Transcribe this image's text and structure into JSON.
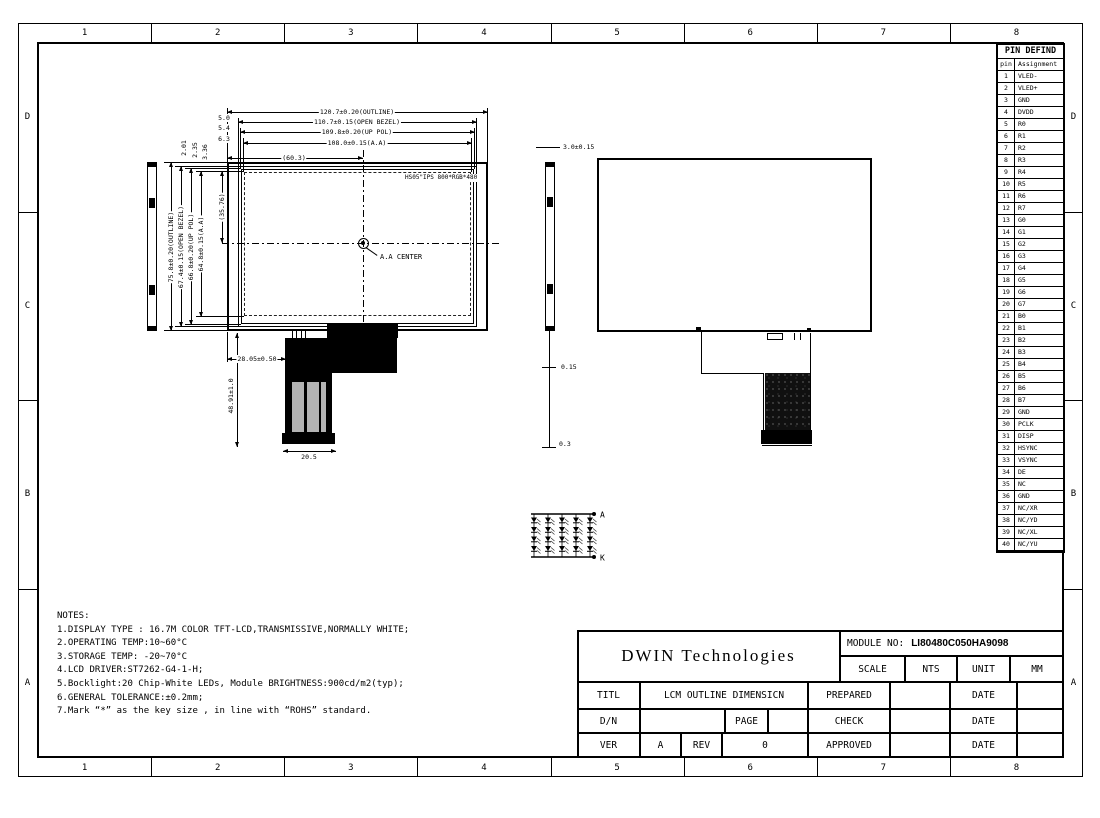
{
  "sheet": {
    "cols": [
      "1",
      "2",
      "3",
      "4",
      "5",
      "6",
      "7",
      "8"
    ],
    "rows": [
      "D",
      "C",
      "B",
      "A"
    ]
  },
  "front_view": {
    "top_dims": [
      "120.7±0.20(OUTLINE)",
      "110.7±0.15(OPEN BEZEL)",
      "109.8±0.20(UP POL)",
      "108.0±0.15(A.A)"
    ],
    "half_width_dim": "(60.3)",
    "left_dims": [
      "75.8±0.20(OUTLINE)",
      "67.4±0.15(OPEN BEZEL)",
      "66.8±0.20(UP POL)",
      "64.8±0.15(A.A)"
    ],
    "half_height_dim": "(35.76)",
    "left_offsets": [
      "5.0",
      "5.4",
      "6.3"
    ],
    "top_offsets": [
      "2.01",
      "2.35",
      "3.36"
    ],
    "panel_label": "HS05\"IPS 800*RGB*480",
    "center_label": "A.A CENTER",
    "fpc_offset_dim": "28.05±0.50",
    "fpc_length_dim": "48.91±1.0",
    "fpc_width_dim": "20.5"
  },
  "side_view": {
    "thickness_dim": "3.0±0.15",
    "tape_dim": "0.15",
    "protrusion_dim": "0.3"
  },
  "led_circuit": {
    "anode_label": "A",
    "cathode_label": "K",
    "rows": 4,
    "cols": 5
  },
  "notes": {
    "title": "NOTES:",
    "lines": [
      "1.DISPLAY TYPE : 16.7M COLOR TFT-LCD,TRANSMISSIVE,NORMALLY WHITE;",
      "2.OPERATING TEMP:10~60°C",
      "3.STORAGE TEMP: -20~70°C",
      "4.LCD DRIVER:ST7262-G4-1-H;",
      "5.Bocklight:20 Chip-White LEDs, Module BRIGHTNESS:900cd/m2(typ);",
      "6.GENERAL TOLERANCE:±0.2mm;",
      "7.Mark “*” as the key size , in line with “ROHS” standard."
    ]
  },
  "title_block": {
    "company": "DWIN Technologies",
    "module_no_label": "MODULE NO:",
    "module_no_value": "LI80480C050HA9098",
    "scale_label": "SCALE",
    "scale_value": "NTS",
    "unit_label": "UNIT",
    "unit_value": "MM",
    "title_label": "TITL",
    "title_value": "LCM OUTLINE DIMENSICN",
    "prepared_label": "PREPARED",
    "check_label": "CHECK",
    "approved_label": "APPROVED",
    "date_label": "DATE",
    "dn_label": "D/N",
    "page_label": "PAGE",
    "ver_label": "VER",
    "ver_value": "A",
    "rev_label": "REV",
    "rev_value": "0"
  },
  "pin_table": {
    "title": "PIN DEFIND",
    "headers": [
      "pin",
      "Assignment"
    ],
    "pins": [
      [
        "1",
        "VLED-"
      ],
      [
        "2",
        "VLED+"
      ],
      [
        "3",
        "GND"
      ],
      [
        "4",
        "DVDD"
      ],
      [
        "5",
        "R0"
      ],
      [
        "6",
        "R1"
      ],
      [
        "7",
        "R2"
      ],
      [
        "8",
        "R3"
      ],
      [
        "9",
        "R4"
      ],
      [
        "10",
        "R5"
      ],
      [
        "11",
        "R6"
      ],
      [
        "12",
        "R7"
      ],
      [
        "13",
        "G0"
      ],
      [
        "14",
        "G1"
      ],
      [
        "15",
        "G2"
      ],
      [
        "16",
        "G3"
      ],
      [
        "17",
        "G4"
      ],
      [
        "18",
        "G5"
      ],
      [
        "19",
        "G6"
      ],
      [
        "20",
        "G7"
      ],
      [
        "21",
        "B0"
      ],
      [
        "22",
        "B1"
      ],
      [
        "23",
        "B2"
      ],
      [
        "24",
        "B3"
      ],
      [
        "25",
        "B4"
      ],
      [
        "26",
        "B5"
      ],
      [
        "27",
        "B6"
      ],
      [
        "28",
        "B7"
      ],
      [
        "29",
        "GND"
      ],
      [
        "30",
        "PCLK"
      ],
      [
        "31",
        "DISP"
      ],
      [
        "32",
        "HSYNC"
      ],
      [
        "33",
        "VSYNC"
      ],
      [
        "34",
        "DE"
      ],
      [
        "35",
        "NC"
      ],
      [
        "36",
        "GND"
      ],
      [
        "37",
        "NC/XR"
      ],
      [
        "38",
        "NC/YD"
      ],
      [
        "39",
        "NC/XL"
      ],
      [
        "40",
        "NC/YU"
      ]
    ]
  }
}
